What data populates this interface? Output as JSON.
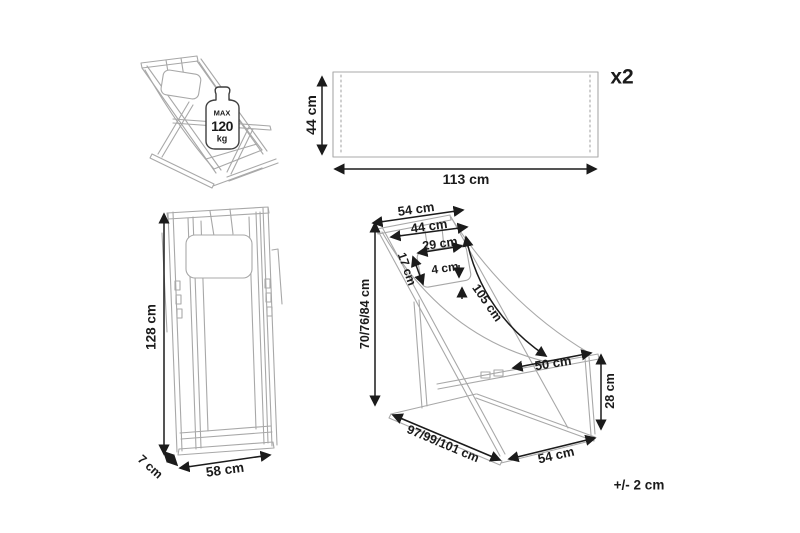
{
  "colors": {
    "background": "#ffffff",
    "drawing_line": "#a8a8a8",
    "dimension": "#1b1b1b"
  },
  "tolerance_note": "+/- 2 cm",
  "perspective_view": {
    "max_load_label": {
      "prefix": "MAX",
      "value": "120",
      "unit": "kg"
    }
  },
  "fabric_panel_view": {
    "height": "44 cm",
    "width": "113 cm",
    "quantity": "x2"
  },
  "folded_front_view": {
    "height": "128 cm",
    "depth": "7 cm",
    "width": "58 cm"
  },
  "open_side_view": {
    "top_width": "54 cm",
    "upper_inner_width": "44 cm",
    "pillow_width": "29 cm",
    "pillow_height": "17 cm",
    "pillow_thickness": "4 cm",
    "fabric_length": "105 cm",
    "adjustable_height": "70/76/84 cm",
    "seat_depth": "50 cm",
    "seat_front_height": "28 cm",
    "adjustable_length": "97/99/101 cm",
    "base_width": "54 cm"
  }
}
